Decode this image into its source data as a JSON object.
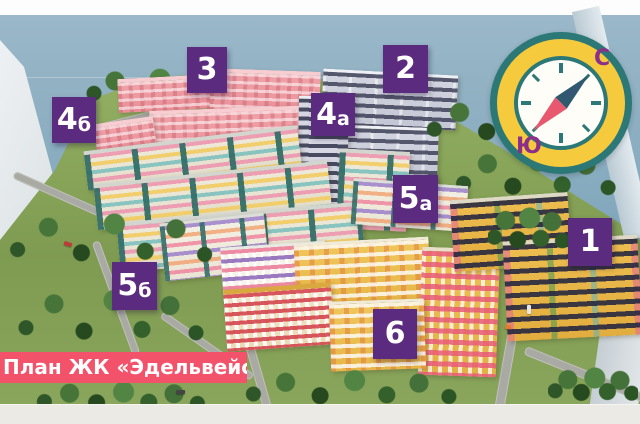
{
  "scene": {
    "title": "План ЖК «Эдельвейс»"
  },
  "markers": [
    {
      "label": "3",
      "main": "3",
      "suffix": ""
    },
    {
      "label": "2",
      "main": "2",
      "suffix": ""
    },
    {
      "label": "4б",
      "main": "4",
      "suffix": "б"
    },
    {
      "label": "4а",
      "main": "4",
      "suffix": "а"
    },
    {
      "label": "5а",
      "main": "5",
      "suffix": "а"
    },
    {
      "label": "1",
      "main": "1",
      "suffix": ""
    },
    {
      "label": "5б",
      "main": "5",
      "suffix": "б"
    },
    {
      "label": "6",
      "main": "6",
      "suffix": ""
    }
  ],
  "compass": {
    "north_label": "С",
    "south_label": "Ю"
  },
  "colors": {
    "marker_purple": "#5b2b80",
    "banner_pink": "#f2536a",
    "compass_yellow": "#f6ca3d",
    "compass_teal": "#2c7877",
    "compass_letters_purple": "#8b2f8a",
    "water_blue": "#8fb0c2",
    "grass_green": "#84a158"
  }
}
